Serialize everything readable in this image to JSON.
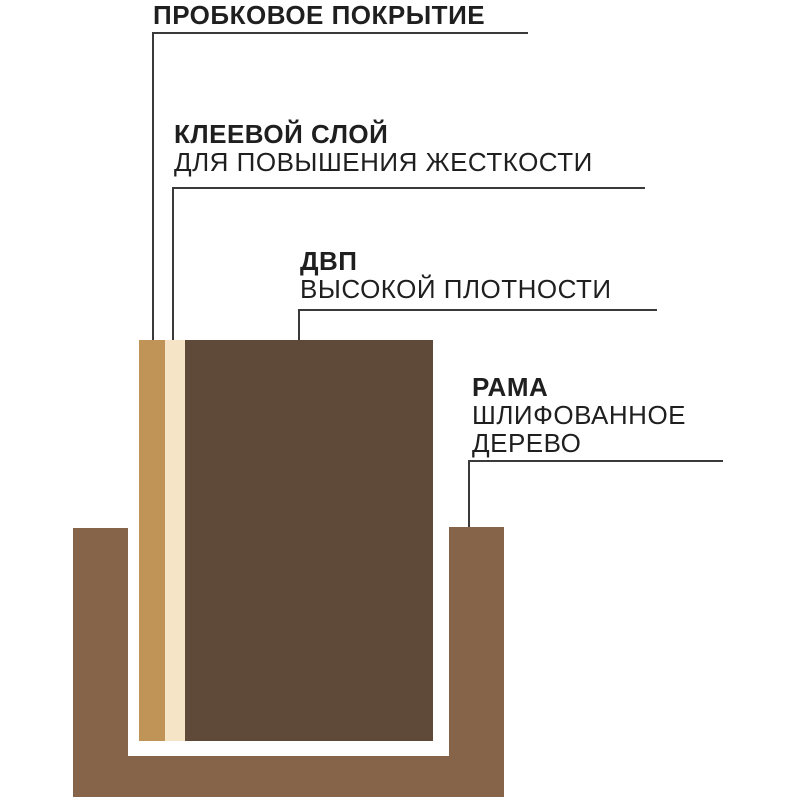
{
  "diagram": {
    "title_hint": "cork board construction layers",
    "labels": {
      "cork": {
        "title": "ПРОБКОВОЕ ПОКРЫТИЕ"
      },
      "glue": {
        "title": "КЛЕЕВОЙ СЛОЙ",
        "subtitle": "ДЛЯ ПОВЫШЕНИЯ ЖЕСТКОСТИ"
      },
      "hdf": {
        "title": "ДВП",
        "subtitle": "ВЫСОКОЙ ПЛОТНОСТИ"
      },
      "frame": {
        "title": "РАМА",
        "subtitle": "ШЛИФОВАННОЕ ДЕРЕВО"
      }
    },
    "colors": {
      "cork_layer": "#bf9456",
      "glue_layer": "#f5e4c6",
      "hdf_panel": "#5f4939",
      "frame_wood": "#85644a",
      "leader_line": "#3a3a3a",
      "text": "#1f1f1f",
      "background": "#ffffff"
    }
  }
}
